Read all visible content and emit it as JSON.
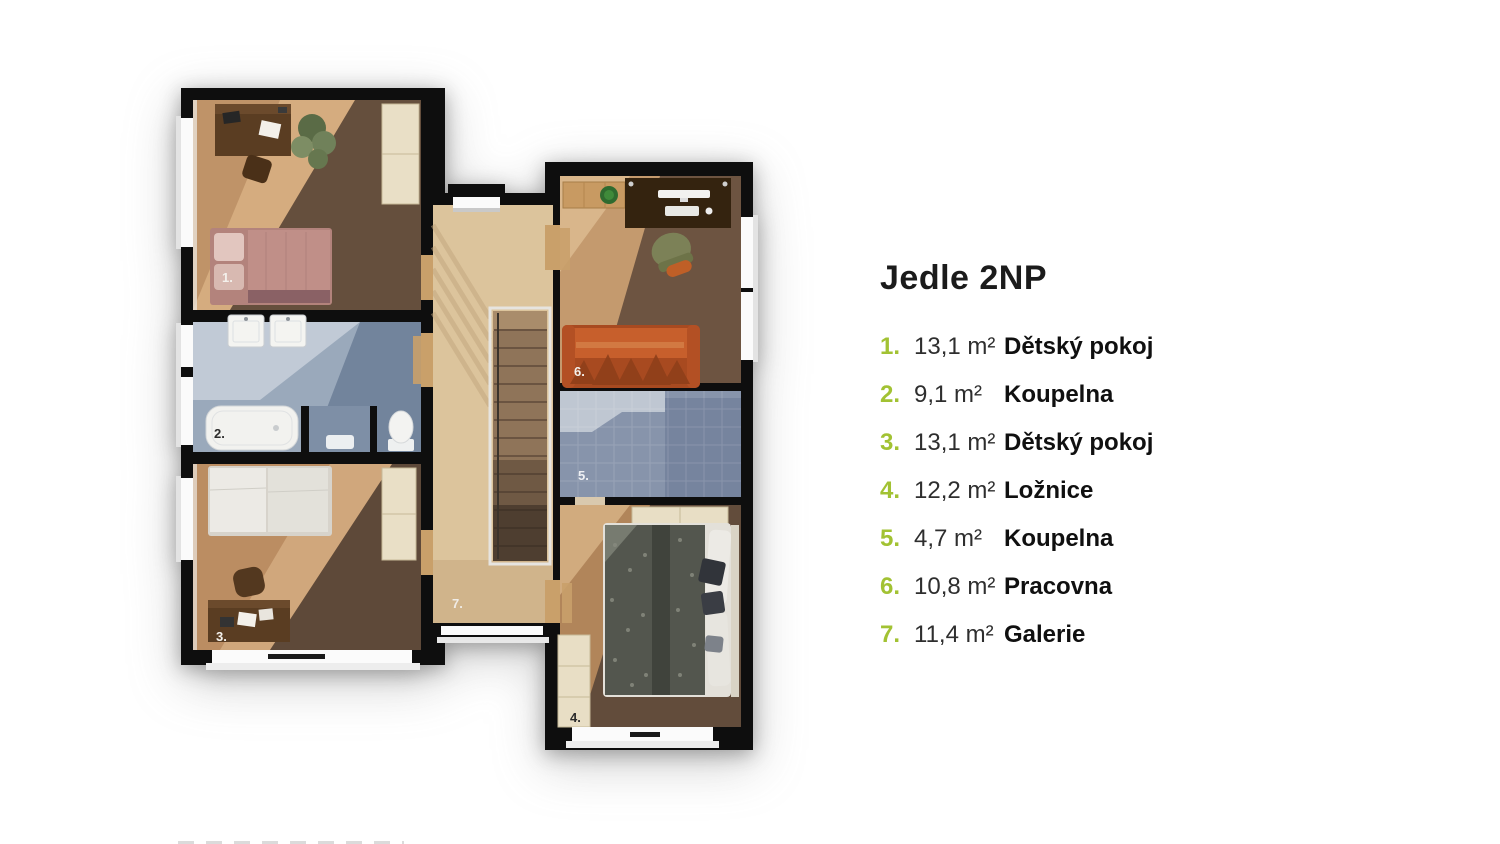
{
  "legend": {
    "title": "Jedle 2NP",
    "accent_color": "#a2c233",
    "text_color": "#1b1b1b",
    "items": [
      {
        "num": "1.",
        "area": "13,1 m²",
        "name": "Dětský pokoj"
      },
      {
        "num": "2.",
        "area": "9,1 m²",
        "name": "Koupelna"
      },
      {
        "num": "3.",
        "area": "13,1 m²",
        "name": "Dětský pokoj"
      },
      {
        "num": "4.",
        "area": "12,2 m²",
        "name": "Ložnice"
      },
      {
        "num": "5.",
        "area": "4,7 m²",
        "name": "Koupelna"
      },
      {
        "num": "6.",
        "area": "10,8 m²",
        "name": "Pracovna"
      },
      {
        "num": "7.",
        "area": "11,4 m²",
        "name": "Galerie"
      }
    ]
  },
  "floorplan": {
    "room_labels": {
      "r1": "1.",
      "r2": "2.",
      "r3": "3.",
      "r4": "4.",
      "r5": "5.",
      "r6": "6.",
      "r7": "7."
    },
    "colors": {
      "wall": "#0e0e0e",
      "wood_light": "#c29468",
      "wood_dark": "#5d4939",
      "gallery_wood": "#dcc49c",
      "tile_light": "#c8d0da",
      "tile_dark": "#6e8099",
      "sofa_orange": "#c75f2c",
      "wardrobe_cream": "#e8dec5"
    }
  }
}
